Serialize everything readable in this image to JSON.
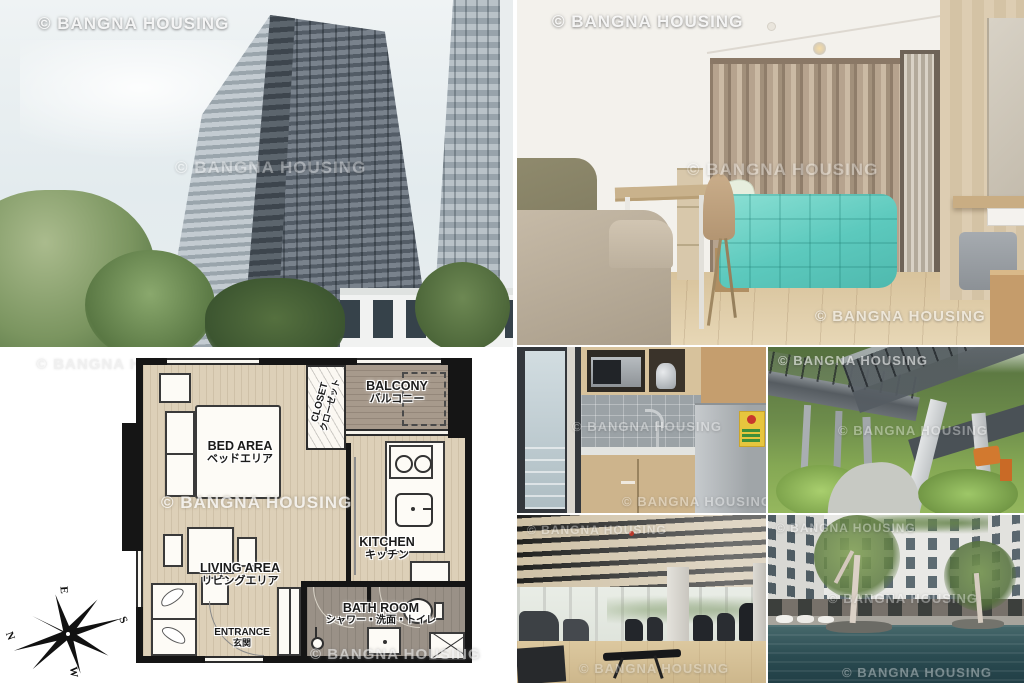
{
  "watermark": {
    "text": "© BANGNA HOUSING"
  },
  "floorplan": {
    "labels": {
      "bed_en": "BED AREA",
      "bed_ja": "ベッドエリア",
      "balcony_en": "BALCONY",
      "balcony_ja": "バルコニー",
      "closet_en": "CLOSET",
      "closet_ja": "クローゼット",
      "kitchen_en": "KITCHEN",
      "kitchen_ja": "キッチン",
      "living_en": "LIVING AREA",
      "living_ja": "リビングエリア",
      "bath_en": "BATH ROOM",
      "bath_ja": "シャワー・洗面・トイレ",
      "entrance_en": "ENTRANCE",
      "entrance_ja": "玄関"
    },
    "compass": {
      "n": "N",
      "e": "E",
      "s": "S",
      "w": "W"
    },
    "colors": {
      "floor": "#ddd0b8",
      "balcony": "#a79a8c",
      "bath": "#9a9187",
      "wall": "#151515"
    }
  },
  "photo_colors": {
    "bed_cover": "#5cc9bd",
    "curtain": "#b6a38e",
    "pool_water": "#2a4b51",
    "garden_green": "#6d8c4b"
  }
}
